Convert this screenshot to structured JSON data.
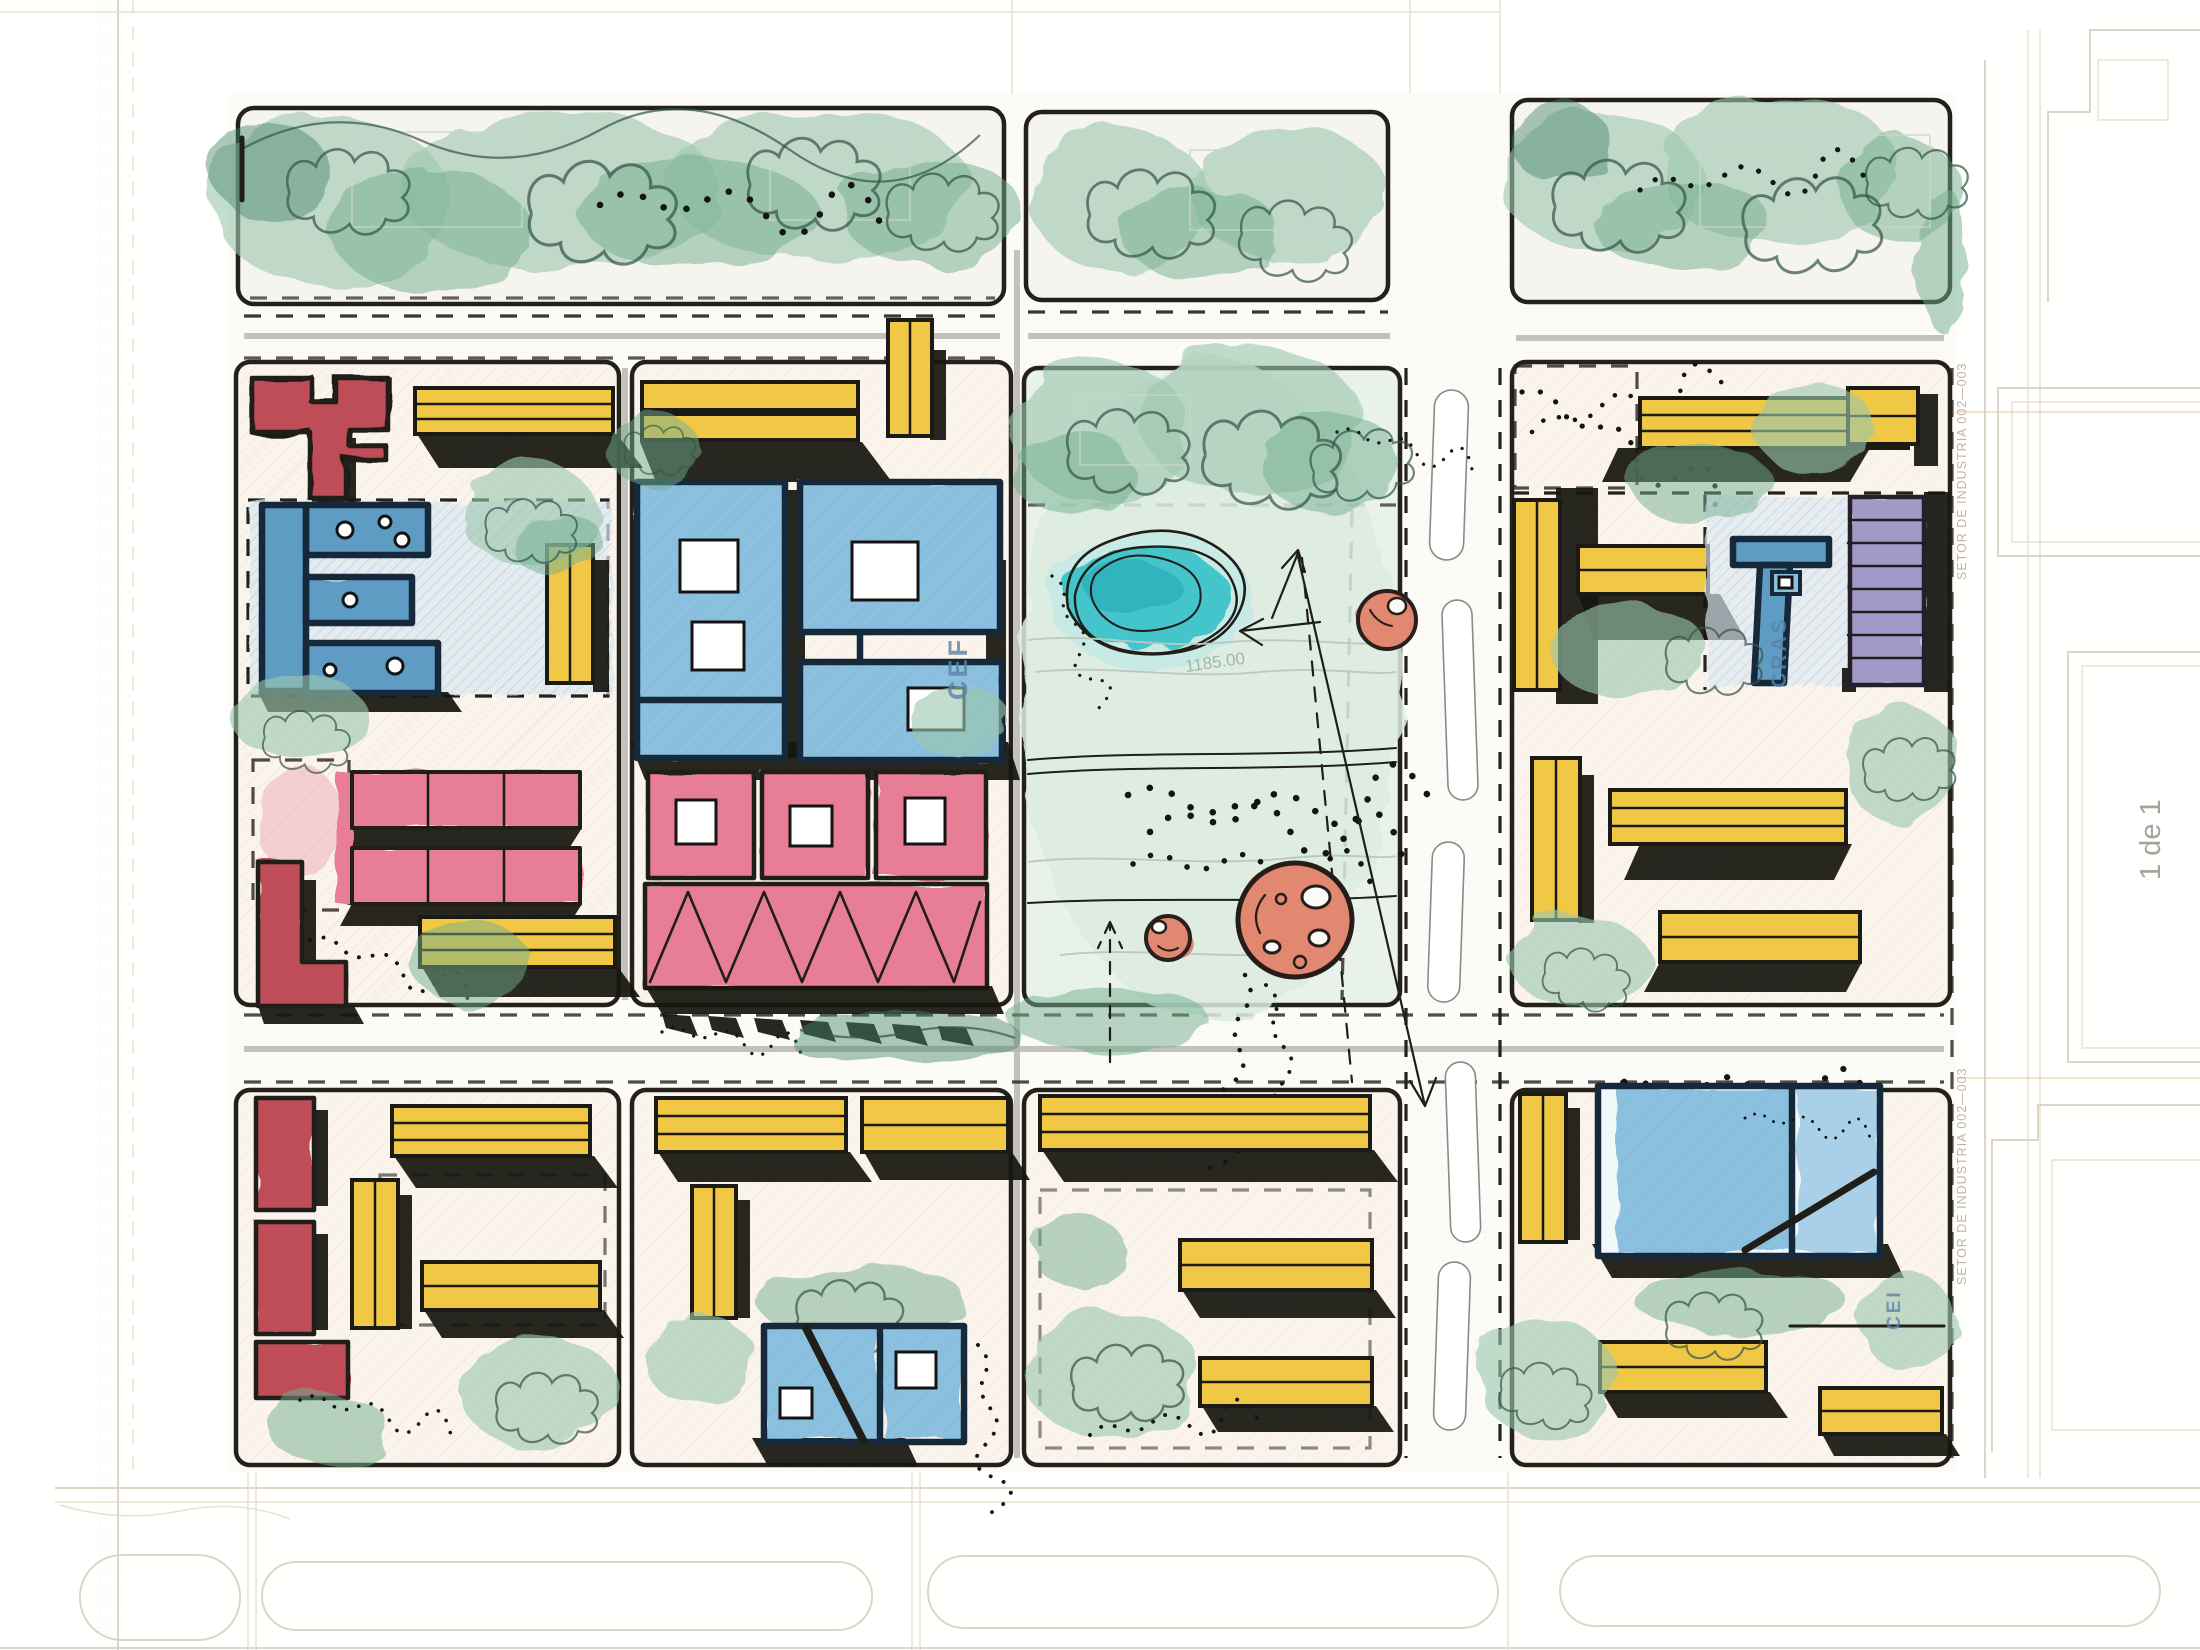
{
  "labels": {
    "school_cef": "CEF",
    "social_center_cras": "CRAS",
    "kindergarten_cei": "CEI",
    "contour_elevation": "1185.00",
    "sector_note_upper": "SETOR DE INDUSTRIA 002—003",
    "sector_note_lower": "SETOR DE INDUSTRIA 002—003",
    "sheet_number": "1 de 1"
  },
  "palette": {
    "paper": "#fdfcfa",
    "tree_green": "#8fbfa3",
    "lawn_green": "#dcebe0",
    "pond_teal": "#3ec3c8",
    "building_yellow": "#f0c845",
    "building_blue": "#7fb3d9",
    "building_pink": "#e87d96",
    "building_red": "#c05055",
    "building_purple": "#a29ac6",
    "plaza_coral": "#e2876f",
    "ink": "#1a1a16",
    "cad_line": "#d8cfc2",
    "label_blue": "#5a82a8"
  }
}
